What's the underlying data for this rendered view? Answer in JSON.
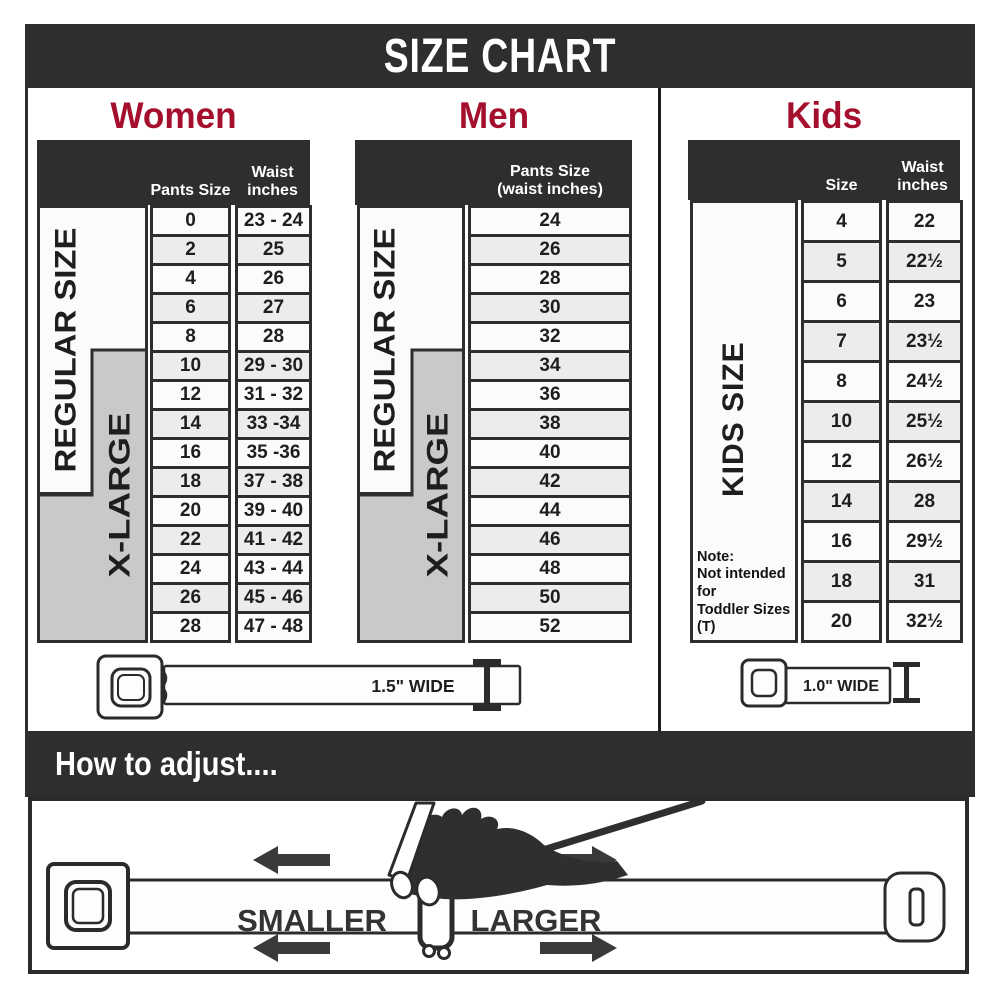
{
  "title": "SIZE CHART",
  "colors": {
    "bar_dark": "#2e2e2e",
    "heading_red": "#a50f2e",
    "xlarge_gray": "#c9c9c9",
    "row_alt_gray": "#ececec",
    "row_white": "#fbfbfb"
  },
  "women": {
    "heading": "Women",
    "col1_header": "Pants Size",
    "col2_header": "Waist\ninches",
    "regular_label": "REGULAR SIZE",
    "xlarge_label": "X-LARGE",
    "rows": [
      {
        "size": "0",
        "waist": "23 - 24"
      },
      {
        "size": "2",
        "waist": "25"
      },
      {
        "size": "4",
        "waist": "26"
      },
      {
        "size": "6",
        "waist": "27"
      },
      {
        "size": "8",
        "waist": "28"
      },
      {
        "size": "10",
        "waist": "29 - 30"
      },
      {
        "size": "12",
        "waist": "31 - 32"
      },
      {
        "size": "14",
        "waist": "33 -34"
      },
      {
        "size": "16",
        "waist": "35 -36"
      },
      {
        "size": "18",
        "waist": "37 - 38"
      },
      {
        "size": "20",
        "waist": "39 - 40"
      },
      {
        "size": "22",
        "waist": "41 - 42"
      },
      {
        "size": "24",
        "waist": "43 - 44"
      },
      {
        "size": "26",
        "waist": "45 - 46"
      },
      {
        "size": "28",
        "waist": "47 - 48"
      }
    ]
  },
  "men": {
    "heading": "Men",
    "col_header": "Pants Size\n(waist inches)",
    "regular_label": "REGULAR SIZE",
    "xlarge_label": "X-LARGE",
    "rows": [
      "24",
      "26",
      "28",
      "30",
      "32",
      "34",
      "36",
      "38",
      "40",
      "42",
      "44",
      "46",
      "48",
      "50",
      "52"
    ]
  },
  "kids": {
    "heading": "Kids",
    "col1_header": "Size",
    "col2_header": "Waist\ninches",
    "band_label": "KIDS SIZE",
    "note": "Note:\nNot intended for\nToddler Sizes (T)",
    "rows": [
      {
        "size": "4",
        "waist": "22"
      },
      {
        "size": "5",
        "waist": "22½"
      },
      {
        "size": "6",
        "waist": "23"
      },
      {
        "size": "7",
        "waist": "23½"
      },
      {
        "size": "8",
        "waist": "24½"
      },
      {
        "size": "10",
        "waist": "25½"
      },
      {
        "size": "12",
        "waist": "26½"
      },
      {
        "size": "14",
        "waist": "28"
      },
      {
        "size": "16",
        "waist": "29½"
      },
      {
        "size": "18",
        "waist": "31"
      },
      {
        "size": "20",
        "waist": "32½"
      }
    ]
  },
  "belts": {
    "adult_width_label": "1.5\" WIDE",
    "kids_width_label": "1.0\" WIDE"
  },
  "adjust": {
    "heading": "How to adjust....",
    "smaller_label": "SMALLER",
    "larger_label": "LARGER"
  }
}
